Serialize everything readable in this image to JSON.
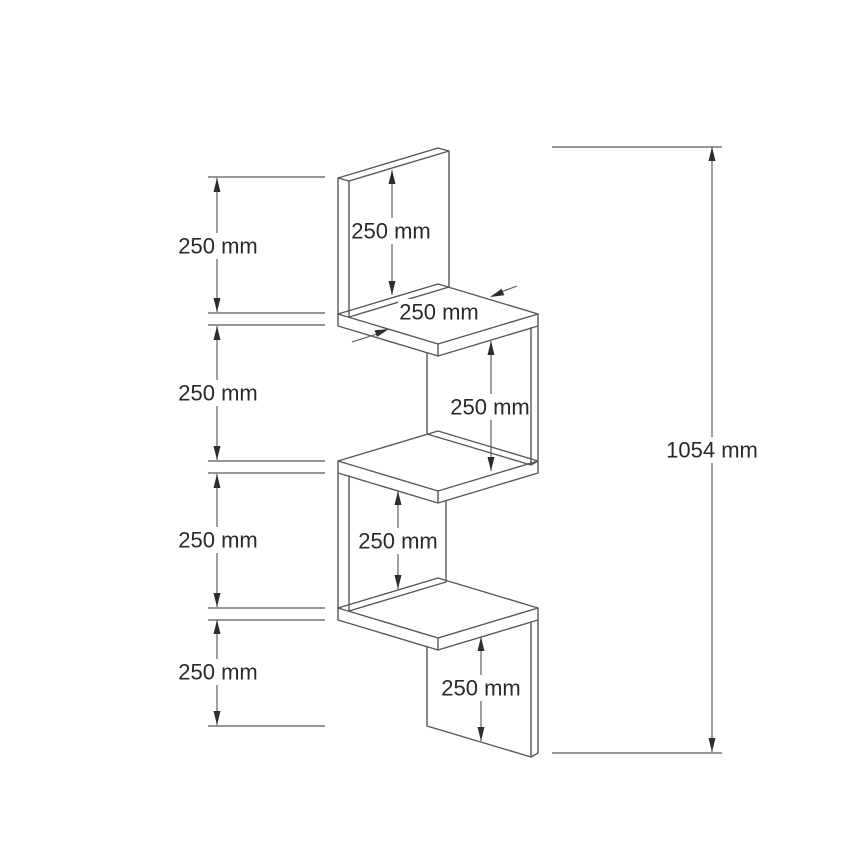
{
  "colors": {
    "background": "#ffffff",
    "geometry_line": "#56575b",
    "dimension_line": "#58595d",
    "arrow": "#2c2d30",
    "text": "#28292c"
  },
  "labels": {
    "left_top_section": "250 mm",
    "left_upper_middle_section": "250 mm",
    "left_lower_middle_section": "250 mm",
    "left_bottom_section": "250 mm",
    "back_panel_height": "250 mm",
    "shelf_depth": "250 mm",
    "upper_bay_height": "250 mm",
    "lower_bay_height": "250 mm",
    "bottom_panel_height": "250 mm",
    "total_height": "1054 mm"
  }
}
